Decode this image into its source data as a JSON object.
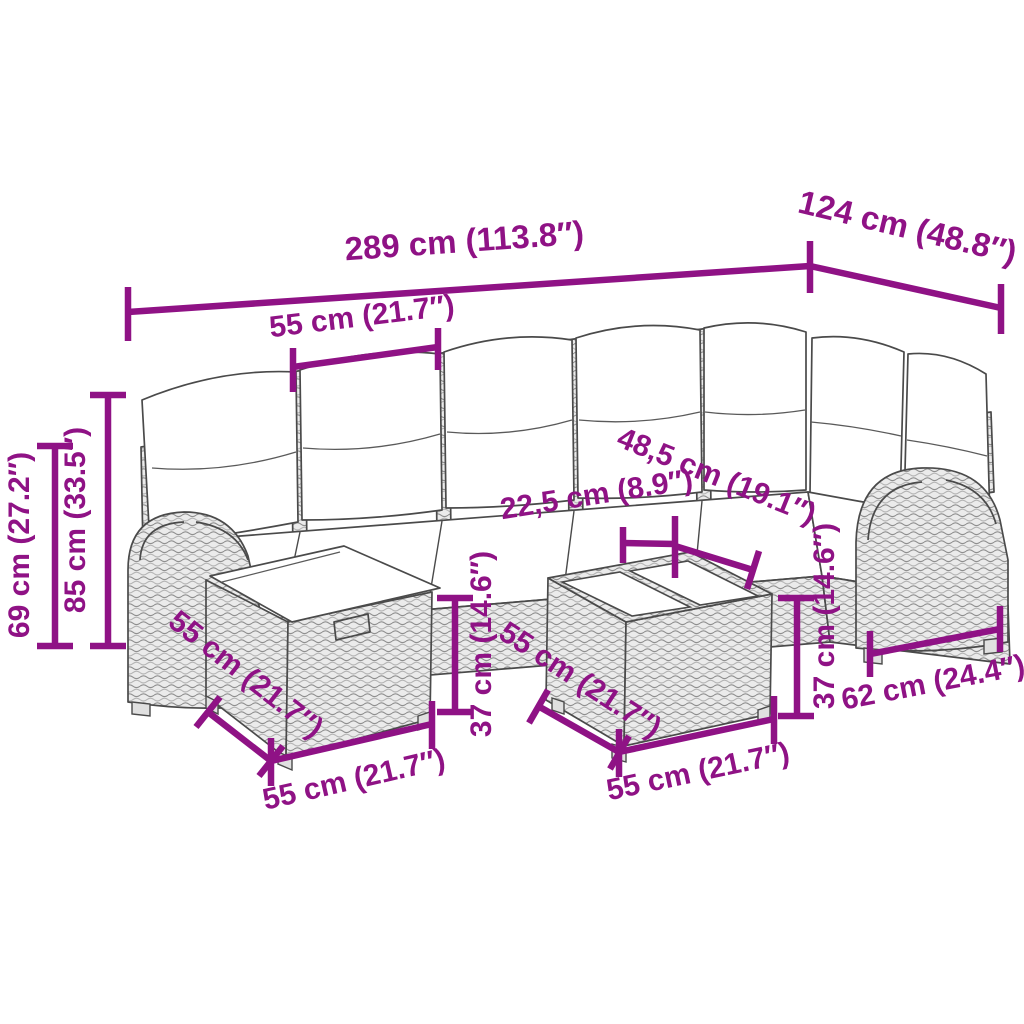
{
  "page": {
    "description_label": "garden-furniture-set-dimension-diagram"
  },
  "colors": {
    "dimension_magenta": "#8F1285",
    "line_art_gray": "#4a4a4a",
    "rattan_fill": "#ebebeb",
    "cushion_white": "#ffffff",
    "background": "#ffffff"
  },
  "dimensions": {
    "total_width": "289 cm (113.8″)",
    "right_section_width": "124 cm (48.8″)",
    "seat_width": "55 cm (21.7″)",
    "armrest_height": "69 cm (27.2″)",
    "backrest_height": "85 cm (33.5″)",
    "table_sofa_gap": "22,5 cm (8.9″)",
    "corner_clearance": "48,5 cm (19.1″)",
    "ottoman_height": "37 cm (14.6″)",
    "table_height": "37 cm (14.6″)",
    "seat_depth": "62 cm (24.4″)",
    "ottoman_depth": "55 cm (21.7″)",
    "ottoman_width": "55 cm (21.7″)",
    "table_depth": "55 cm (21.7″)",
    "table_width": "55 cm (21.7″)"
  }
}
